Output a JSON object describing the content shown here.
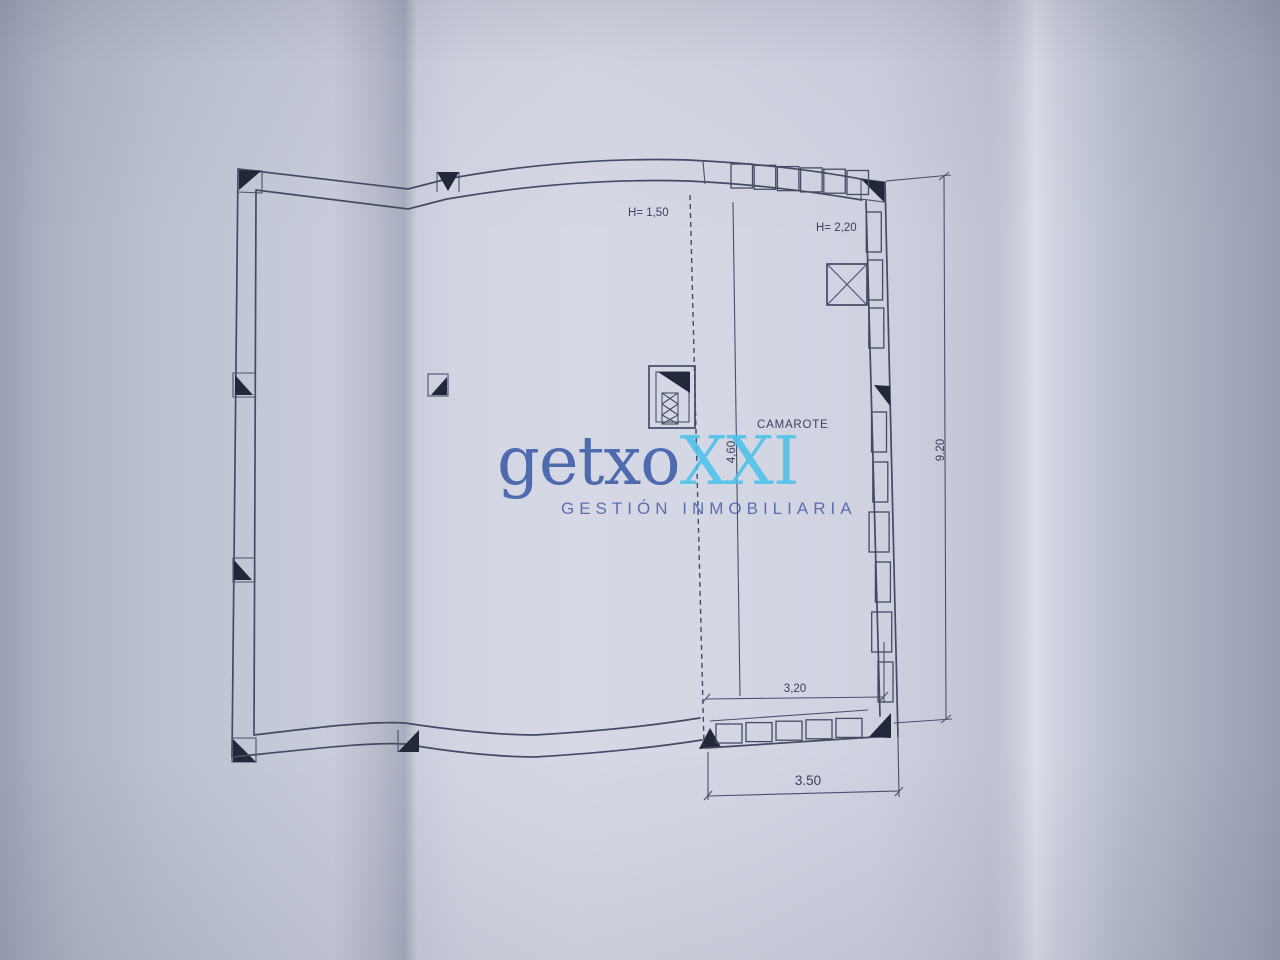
{
  "watermark": {
    "logo_main": "getxo",
    "logo_accent": "XXI",
    "tagline": "GESTIÓN INMOBILIARIA",
    "colors": {
      "logo_main": "#3c5ca9",
      "logo_accent": "#4cc2e9",
      "tagline": "#4a60ae"
    }
  },
  "plan": {
    "room_label": "CAMAROTE",
    "height_label_left": "H= 1,50",
    "height_label_right": "H= 2,20",
    "dim_right_height": "9,20",
    "dim_partition_height": "4,60",
    "dim_inner_width": "3,20",
    "dim_outer_width": "3.50",
    "line_color": "#454b62",
    "marker_color": "#23273a"
  }
}
